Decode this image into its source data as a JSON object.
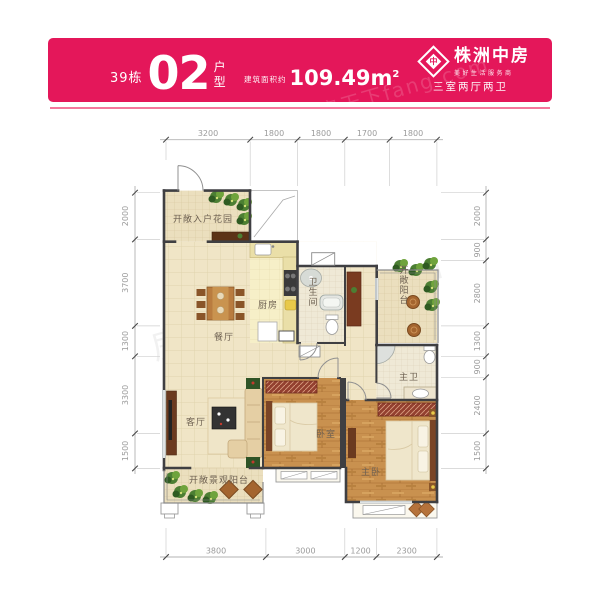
{
  "header": {
    "building": "39栋",
    "unit_number": "02",
    "type_char_top": "户",
    "type_char_bottom": "型",
    "area_label": "建筑面积约",
    "area_value": "109.49m",
    "area_sup": "2",
    "brand": "株洲中房",
    "brand_mark": "中",
    "tagline": "美好生活服务商",
    "layout_desc": "三室两厅两卫"
  },
  "watermark": {
    "header": "房天下fang.com",
    "plan": "房天下fang.com"
  },
  "rooms": {
    "entry_garden": "开敞入户花园",
    "kitchen": "厨房",
    "bathroom": "卫生间",
    "balcony": "开敞阳台",
    "dining": "餐厅",
    "living": "客厅",
    "view_balcony": "开敞景观阳台",
    "bedroom": "卧室",
    "master_bedroom": "主卧",
    "master_bath": "主卫"
  },
  "dims": {
    "top": [
      "3200",
      "1800",
      "1800",
      "1700",
      "1800"
    ],
    "bottom": [
      "3800",
      "3000",
      "1200",
      "2300"
    ],
    "left": [
      "2000",
      "3700",
      "1300",
      "3300",
      "1500"
    ],
    "right": [
      "2000",
      "900",
      "2800",
      "1300",
      "900",
      "2400",
      "1500"
    ]
  },
  "colors": {
    "header_bg": "#E4175A",
    "ribbon": "#F4779C",
    "wall": "#3F3F42",
    "tile_floor": "#F0E5C6",
    "wood_floor": "#C9914F",
    "wardrobe": "#93402F",
    "plant": "#4C7F33",
    "dim_text": "#9B9B9B",
    "label_text": "#6E6152"
  }
}
